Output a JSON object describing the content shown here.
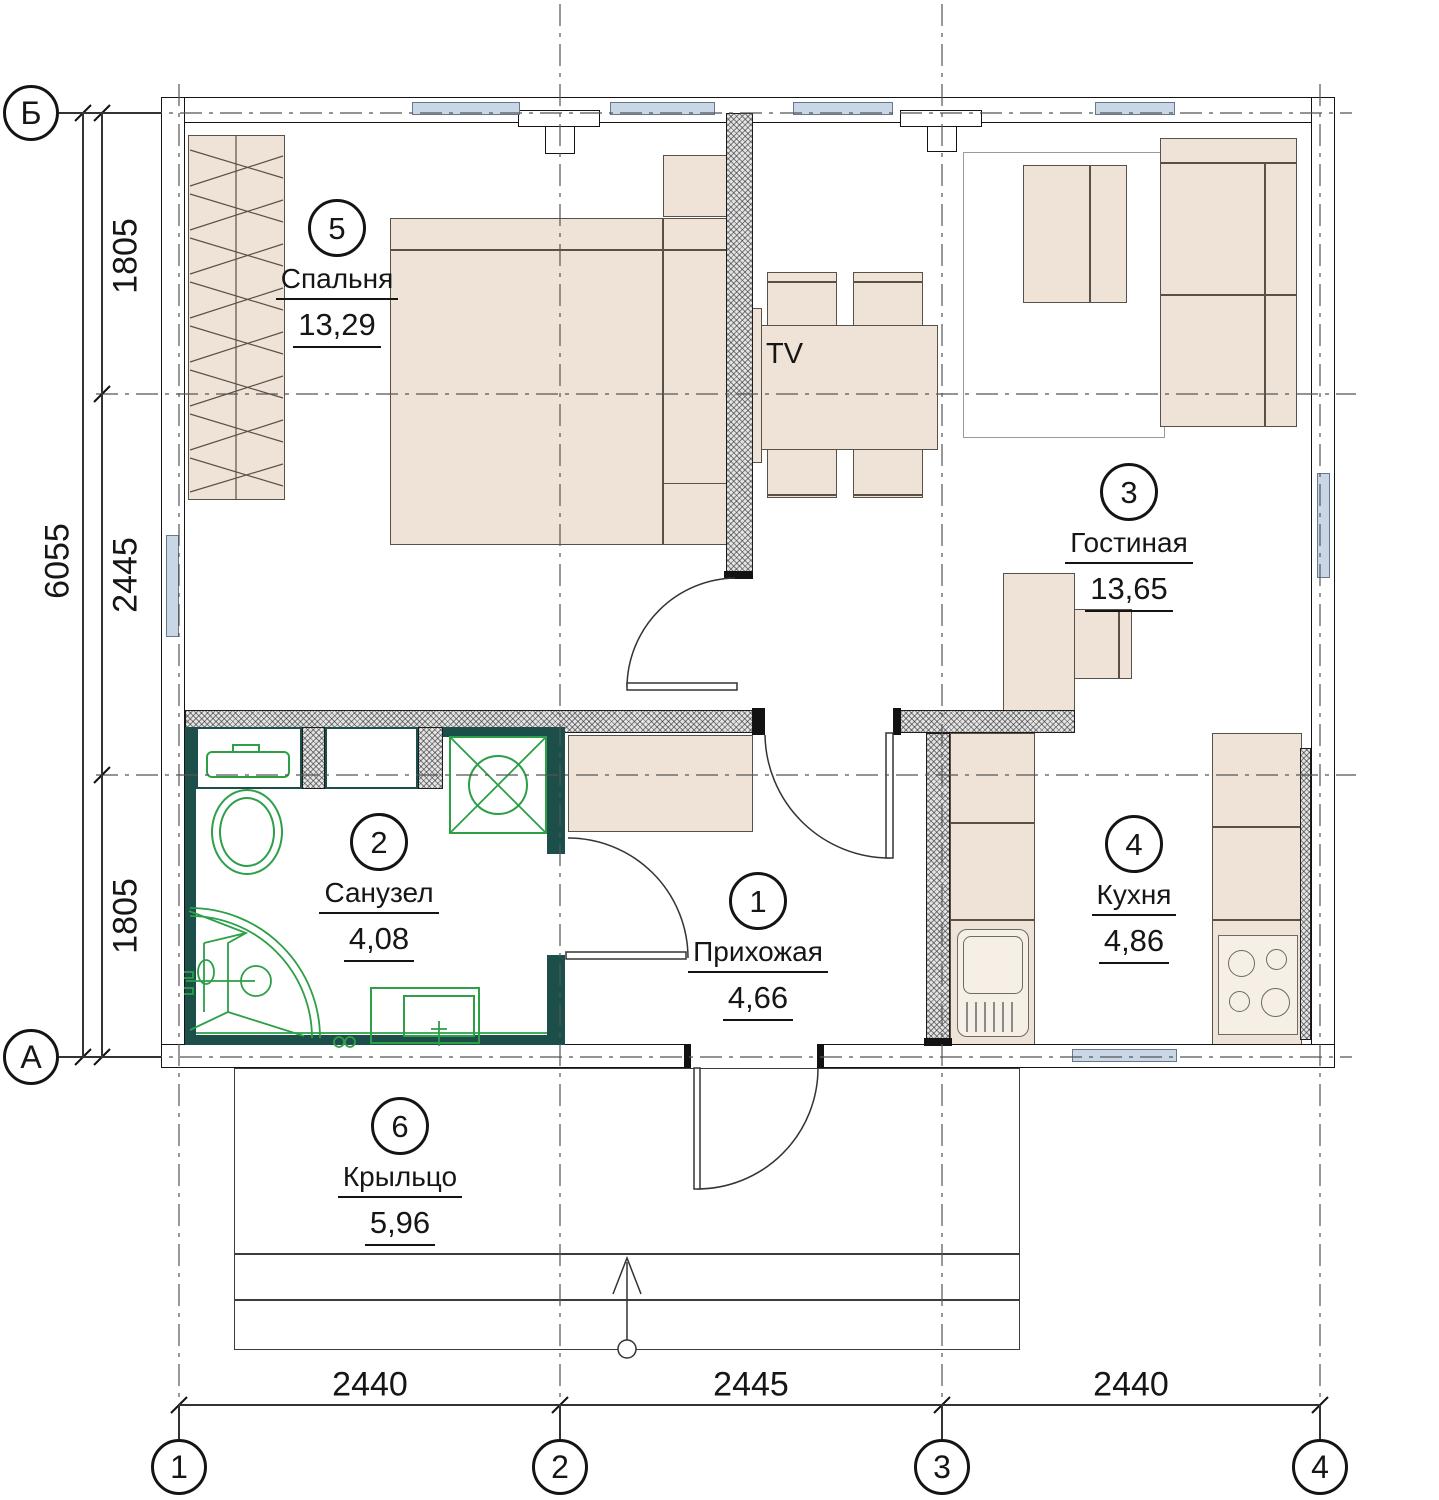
{
  "axes": {
    "cols": [
      "1",
      "2",
      "3",
      "4"
    ],
    "rows": [
      "Б",
      "А"
    ]
  },
  "dims": {
    "left_total": "6055",
    "left_segments": [
      "1805",
      "2445",
      "1805"
    ],
    "bottom_segments": [
      "2440",
      "2445",
      "2440"
    ]
  },
  "rooms": [
    {
      "number": "1",
      "name": "Прихожая",
      "area": "4,66"
    },
    {
      "number": "2",
      "name": "Санузел",
      "area": "4,08"
    },
    {
      "number": "3",
      "name": "Гостиная",
      "area": "13,65"
    },
    {
      "number": "4",
      "name": "Кухня",
      "area": "4,86"
    },
    {
      "number": "5",
      "name": "Спальня",
      "area": "13,29"
    },
    {
      "number": "6",
      "name": "Крыльцо",
      "area": "5,96"
    }
  ],
  "annotations": {
    "tv_label": "TV"
  },
  "colors": {
    "furniture_fill": "#eee3d6",
    "fixture_green": "#2c9f47",
    "wall_teal": "#1d4f4a",
    "window_blue": "#c9d6e6"
  }
}
